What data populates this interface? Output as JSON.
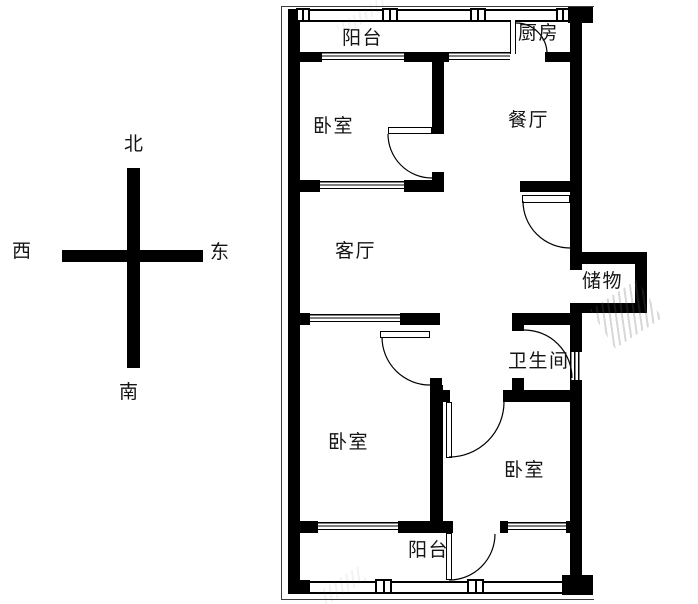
{
  "title": "apartment-floor-plan",
  "compass": {
    "north": "北",
    "south": "南",
    "east": "东",
    "west": "西"
  },
  "rooms": {
    "balcony_north": "阳台",
    "kitchen": "厨房",
    "bedroom_north": "卧室",
    "dining": "餐厅",
    "living": "客厅",
    "storage": "储物",
    "bathroom": "卫生间",
    "bedroom_southwest": "卧室",
    "bedroom_southeast": "卧室",
    "balcony_south": "阳台"
  },
  "colors": {
    "wall": "#000000",
    "background": "#ffffff",
    "label": "#141414"
  }
}
